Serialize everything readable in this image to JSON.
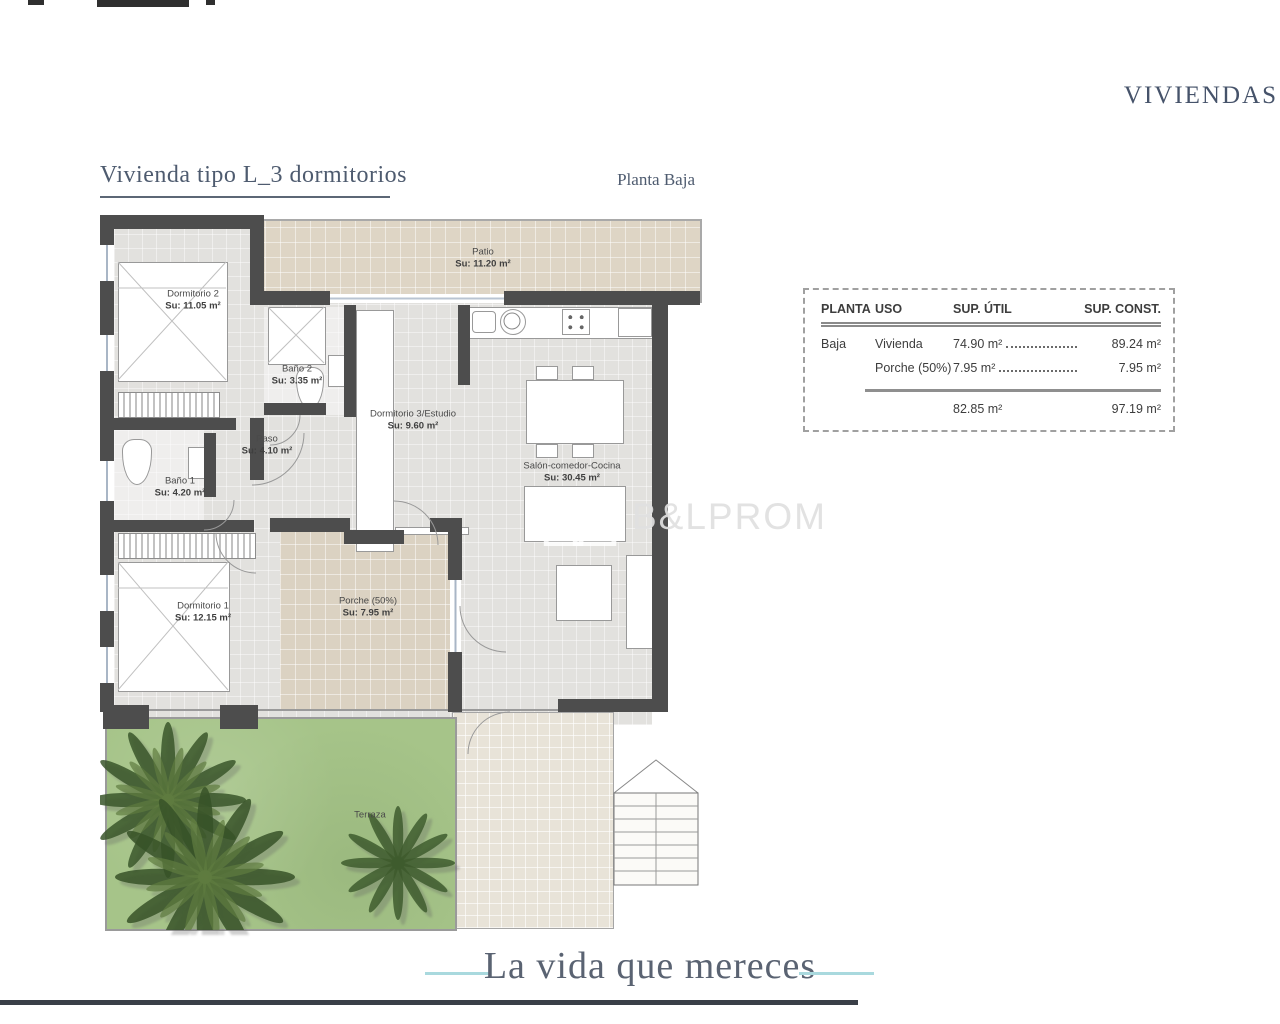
{
  "brand": "VIVIENDAS",
  "plan": {
    "title": "Vivienda tipo L_3 dormitorios",
    "floor_label": "Planta Baja"
  },
  "rooms": [
    {
      "name": "Patio",
      "area": "Su:  11.20 m²"
    },
    {
      "name": "Dormitorio 2",
      "area": "Su: 11.05 m²"
    },
    {
      "name": "Baño 2",
      "area": "Su:  3.35 m²"
    },
    {
      "name": "Dormitorio 3/Estudio",
      "area": "Su: 9.60 m²"
    },
    {
      "name": "Paso",
      "area": "Su: 4.10 m²"
    },
    {
      "name": "Baño 1",
      "area": "Su: 4.20 m²"
    },
    {
      "name": "Salón-comedor-Cocina",
      "area": "Su: 30.45 m²"
    },
    {
      "name": "Dormitorio 1",
      "area": "Su: 12.15 m²"
    },
    {
      "name": "Porche (50%)",
      "area": "Su: 7.95 m²"
    },
    {
      "name": "Terraza",
      "area": ""
    }
  ],
  "summary_table": {
    "col_planta": "PLANTA",
    "col_uso": "USO",
    "col_util": "SUP. ÚTIL",
    "col_const": "SUP. CONST.",
    "rows": [
      {
        "planta": "Baja",
        "uso": "Vivienda",
        "util": "74.90 m²",
        "const": "89.24 m²"
      },
      {
        "planta": "",
        "uso": "Porche (50%)",
        "util": "7.95 m²",
        "const": "7.95 m²"
      }
    ],
    "total_util": "82.85 m²",
    "total_const": "97.19 m²"
  },
  "watermark": {
    "text": "B&LPROM"
  },
  "footer": {
    "tagline": "La vida que mereces"
  },
  "colors": {
    "wall": "#4d4d4d",
    "heading": "#4e5b6f",
    "accent_teal": "#a9d9de",
    "grass": "#a6c489",
    "tile_beige": "#ded5c5",
    "rule_dark": "#3a3f48"
  }
}
